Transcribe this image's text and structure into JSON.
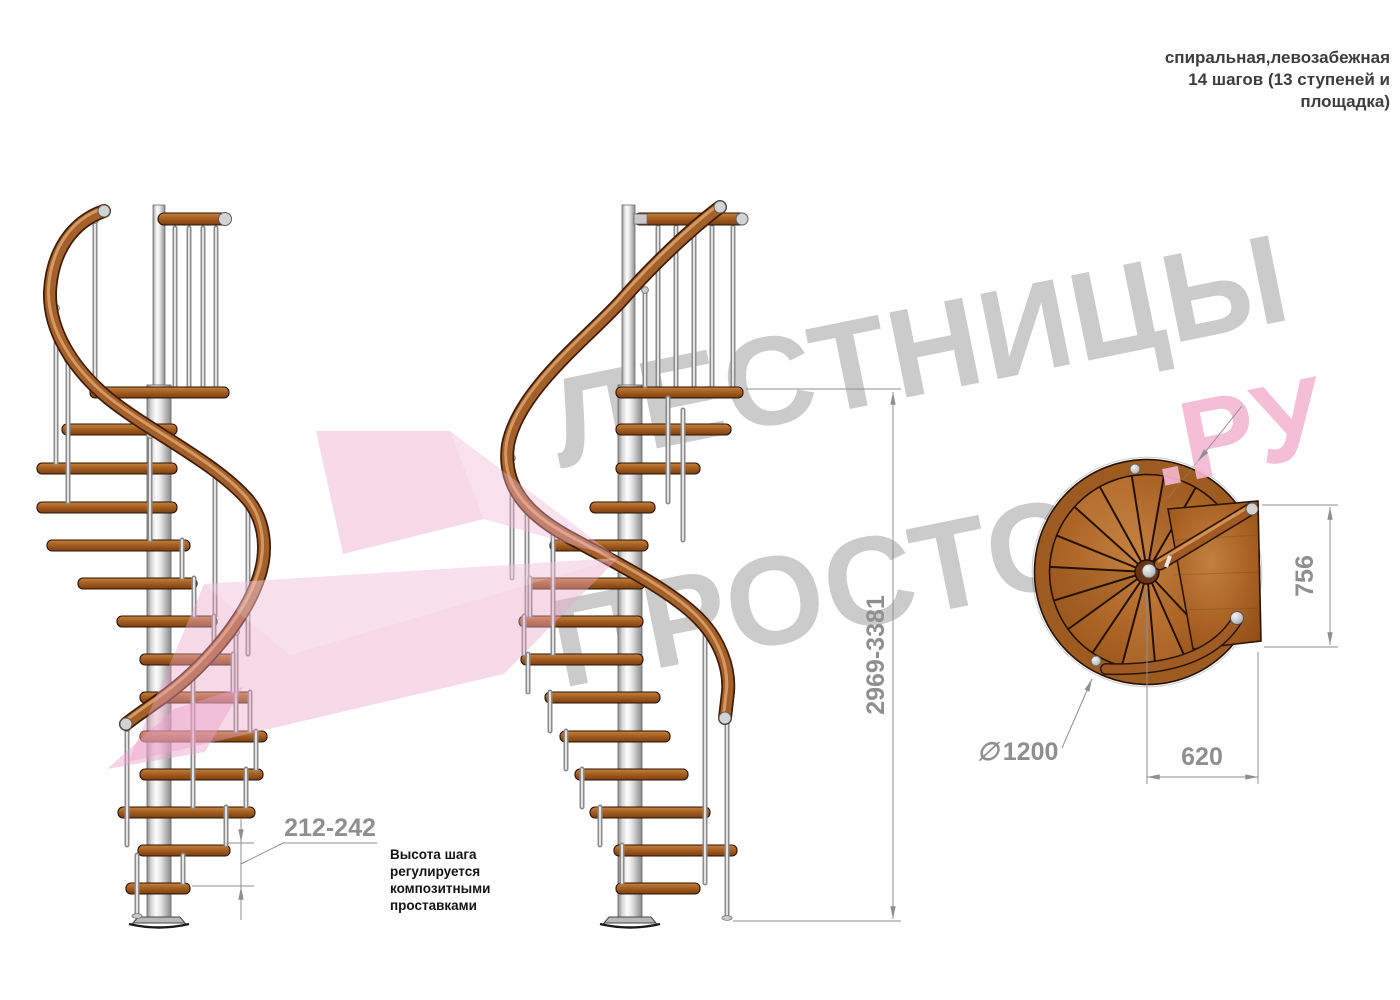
{
  "title_note": {
    "line1": "спиральная,левозабежная",
    "line2": "14 шагов (13 ступеней и",
    "line3": "площадка)"
  },
  "watermark": {
    "word1": "ЛЕСТНИЦЫ",
    "word2": "ПРОСТО",
    "word3": ".РУ"
  },
  "dimensions": {
    "total_height": "2969-3381",
    "step_height": "212-242",
    "diameter_symbol": "∅",
    "diameter_value": "1200",
    "platform_width": "620",
    "platform_depth": "756"
  },
  "annotation": {
    "line1": "Высота шага",
    "line2": "регулируется",
    "line3": "композитными",
    "line4": "проставками"
  },
  "colors": {
    "wood": "#a8661f",
    "metal": "#c9c9c9",
    "dimension_gray": "#8f8f8f",
    "watermark_gray": "#cbcbcb",
    "watermark_pink": "#f5b8d3"
  }
}
